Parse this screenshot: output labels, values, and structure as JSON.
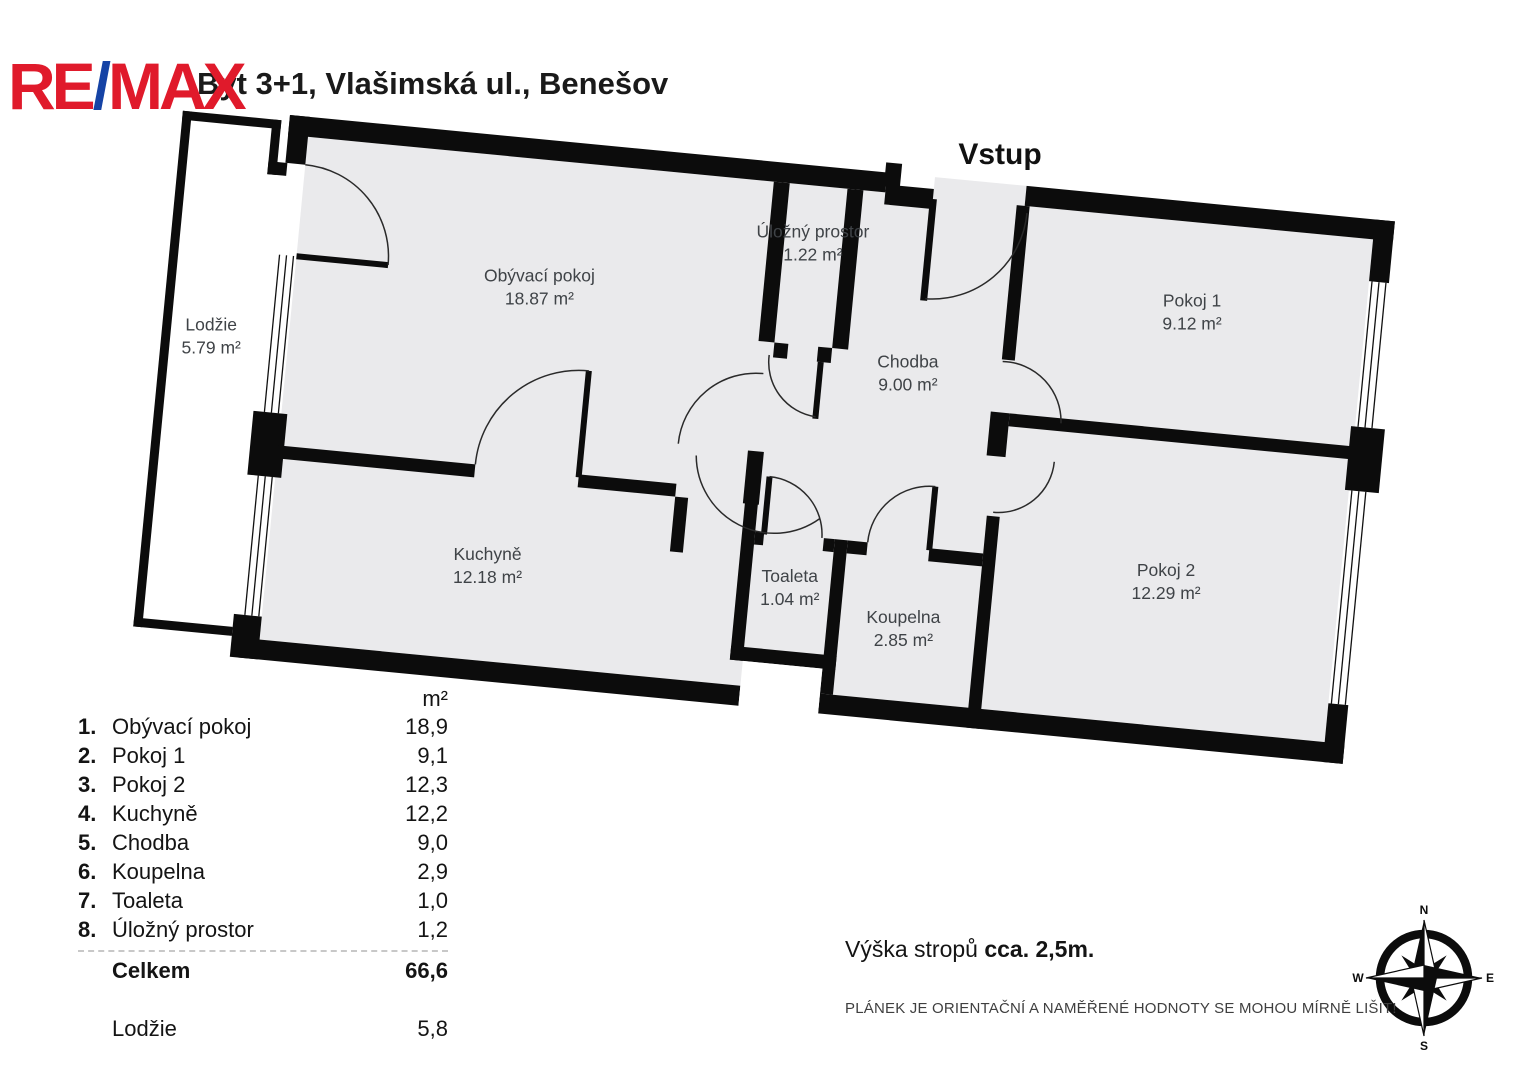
{
  "header": {
    "title": "Byt 3+1, Vlašimská ul., Benešov",
    "logo": {
      "re": "RE",
      "slash": "/",
      "max": "MAX",
      "red": "#e01a2b",
      "blue": "#1543a5"
    }
  },
  "plan": {
    "entrance_label": "Vstup",
    "wall_color": "#0c0c0c",
    "floor_color": "#eaeaec",
    "rooms": [
      {
        "name": "Obývací pokoj",
        "area": "18.87 m²"
      },
      {
        "name": "Úložný prostor",
        "area": "1.22 m²"
      },
      {
        "name": "Chodba",
        "area": "9.00 m²"
      },
      {
        "name": "Pokoj 1",
        "area": "9.12 m²"
      },
      {
        "name": "Pokoj 2",
        "area": "12.29 m²"
      },
      {
        "name": "Kuchyně",
        "area": "12.18 m²"
      },
      {
        "name": "Toaleta",
        "area": "1.04 m²"
      },
      {
        "name": "Koupelna",
        "area": "2.85 m²"
      },
      {
        "name": "Lodžie",
        "area": "5.79 m²"
      }
    ]
  },
  "legend": {
    "unit_header": "m²",
    "rows": [
      {
        "num": "1.",
        "name": "Obývací pokoj",
        "value": "18,9"
      },
      {
        "num": "2.",
        "name": "Pokoj 1",
        "value": "9,1"
      },
      {
        "num": "3.",
        "name": "Pokoj 2",
        "value": "12,3"
      },
      {
        "num": "4.",
        "name": "Kuchyně",
        "value": "12,2"
      },
      {
        "num": "5.",
        "name": "Chodba",
        "value": "9,0"
      },
      {
        "num": "6.",
        "name": "Koupelna",
        "value": "2,9"
      },
      {
        "num": "7.",
        "name": "Toaleta",
        "value": "1,0"
      },
      {
        "num": "8.",
        "name": "Úložný prostor",
        "value": "1,2"
      }
    ],
    "total": {
      "name": "Celkem",
      "value": "66,6"
    },
    "extra": {
      "name": "Lodžie",
      "value": "5,8"
    }
  },
  "notes": {
    "ceiling_prefix": "Výška stropů ",
    "ceiling_bold": "cca. 2,5m.",
    "disclaimer": "PLÁNEK JE ORIENTAČNÍ A NAMĚŘENÉ HODNOTY SE MOHOU MÍRNĚ LIŠIT!"
  },
  "compass": {
    "n": "N",
    "e": "E",
    "s": "S",
    "w": "W"
  }
}
